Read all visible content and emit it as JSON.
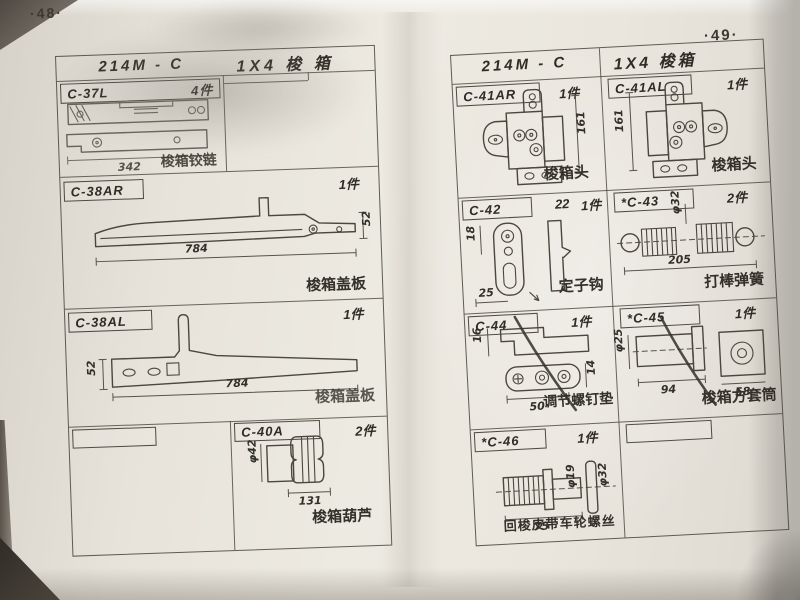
{
  "left_page": {
    "page_number": "·48·",
    "header": {
      "model": "214M - C",
      "title": "1X4 梭 箱"
    },
    "c37": {
      "code": "C-37L",
      "qty": "4件",
      "dim_length": "342",
      "label": "梭箱铰链"
    },
    "c38ar": {
      "code": "C-38AR",
      "qty": "1件",
      "dim_length": "784",
      "dim_height": "52",
      "label": "梭箱盖板"
    },
    "c38al": {
      "code": "C-38AL",
      "qty": "1件",
      "dim_length": "784",
      "dim_height": "52",
      "label": "梭箱盖板"
    },
    "c40a": {
      "code": "C-40A",
      "qty": "2件",
      "dim_dia": "φ42",
      "dim_length": "131",
      "label": "梭箱葫芦"
    }
  },
  "right_page": {
    "page_number": "·49·",
    "header": {
      "model": "214M - C",
      "title": "1X4 梭箱"
    },
    "c41ar": {
      "code": "C-41AR",
      "qty": "1件",
      "dim_height": "161",
      "label": "梭箱头"
    },
    "c41al": {
      "code": "C-41AL",
      "qty": "1件",
      "dim_height": "161",
      "label": "梭箱头"
    },
    "c42": {
      "code": "C-42",
      "dim_top": "22",
      "qty": "1件",
      "dim_height": "18",
      "dim_bottom": "25",
      "label": "定子钩"
    },
    "c43": {
      "code": "*C-43",
      "qty": "2件",
      "dim_dia": "φ32",
      "dim_length": "205",
      "label": "打棒弹簧"
    },
    "c44": {
      "code": "C-44",
      "qty": "1件",
      "dim_left": "16",
      "dim_bottom": "50",
      "dim_right": "14",
      "label": "调节螺钉垫"
    },
    "c45": {
      "code": "*C-45",
      "qty": "1件",
      "dim_dia": "φ25",
      "dim_len1": "94",
      "dim_len2": "58",
      "label": "梭箱方套筒"
    },
    "c46": {
      "code": "*C-46",
      "qty": "1件",
      "dim_length": "75",
      "dim_dia1": "φ19",
      "dim_dia2": "φ32",
      "label": "回梭皮带车轮螺丝"
    }
  }
}
